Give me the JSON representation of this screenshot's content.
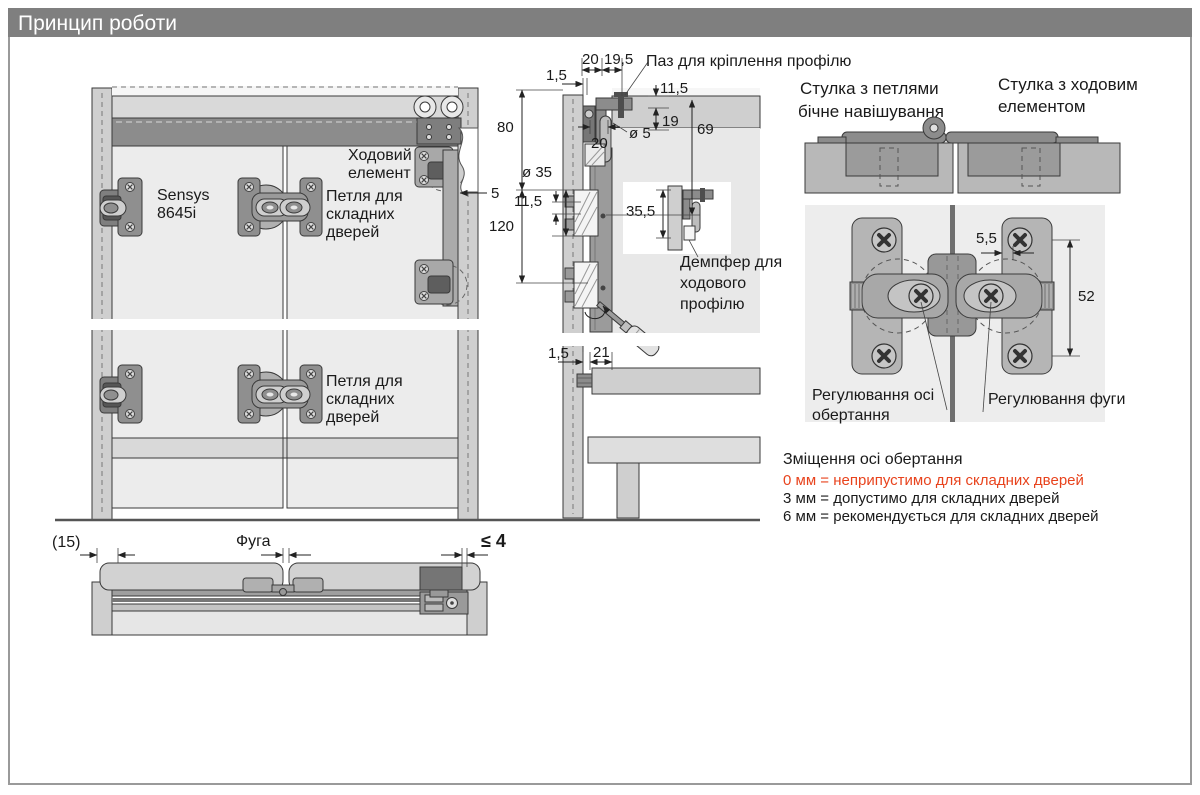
{
  "title": "Принцип роботи",
  "colors": {
    "titlebar": "#7f7f7f",
    "warning_red": "#e8431d"
  },
  "front_view": {
    "sensys": [
      "Sensys",
      "8645i"
    ],
    "runner": [
      "Ходовий",
      "елемент"
    ],
    "hinge_top": [
      "Петля для",
      "складних",
      "дверей"
    ],
    "hinge_bottom": [
      "Петля для",
      "складних",
      "дверей"
    ],
    "dim_5": "5"
  },
  "side_view": {
    "slot_label": "Паз для кріплення профілю",
    "damper_label": [
      "Демпфер для",
      "ходового",
      "профілю"
    ],
    "dims": {
      "w20": "20",
      "w19_5": "19,5",
      "w1_5": "1,5",
      "h11_5": "11,5",
      "h19": "19",
      "dia5": "ø 5",
      "w20b": "20",
      "h69": "69",
      "h80": "80",
      "dia35": "ø 35",
      "h11_5b": "11,5",
      "h120": "120",
      "h35_5": "35,5",
      "w1_5b": "1,5",
      "w21": "21"
    }
  },
  "leaf_section": {
    "left_label": [
      "Стулка з петлями",
      "бічне навішування"
    ],
    "right_label": [
      "Стулка з ходовим",
      "елементом"
    ],
    "dims": {
      "w5_5": "5,5",
      "h52": "52"
    },
    "axis_label": [
      "Регулювання осі",
      "обертання"
    ],
    "gap_label": "Регулювання фуги"
  },
  "offset_info": {
    "heading": "Зміщення осі обертання",
    "line_0mm": "0 мм = неприпустимо для складних дверей",
    "line_3mm": "3 мм = допустимо для складних дверей",
    "line_6mm": "6 мм = рекомендується для складних дверей"
  },
  "plan_view": {
    "dim_15": "(15)",
    "dim_fuga": "Фуга",
    "dim_le4": "≤ 4"
  }
}
